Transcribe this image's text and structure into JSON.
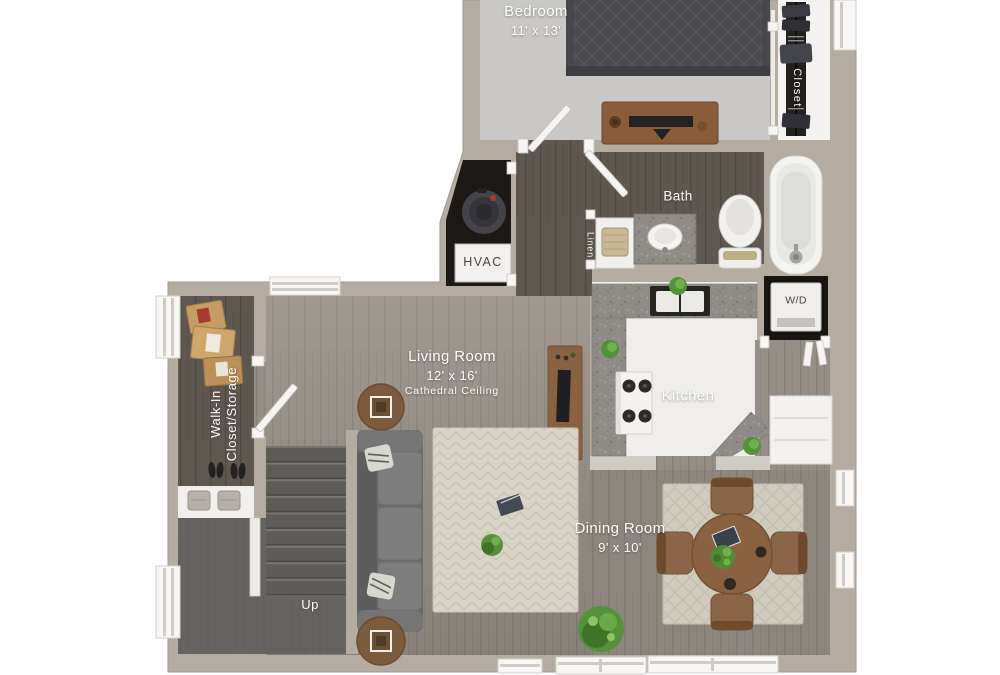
{
  "rooms": {
    "bedroom": {
      "label": "Bedroom",
      "dims": "11' x 13'"
    },
    "bedroom_closet": {
      "label": "Closet"
    },
    "bath": {
      "label": "Bath"
    },
    "linen": {
      "label": "Linen"
    },
    "hvac": {
      "label": "HVAC"
    },
    "kitchen": {
      "label": "Kitchen"
    },
    "laundry": {
      "label": "W/D"
    },
    "living": {
      "label": "Living Room",
      "dims": "12' x 16'",
      "note": "Cathedral Ceiling"
    },
    "dining": {
      "label": "Dining Room",
      "dims": "9' x 10'"
    },
    "walk_in": {
      "label_line1": "Walk-In",
      "label_line2": "Closet/Storage"
    },
    "stairs": {
      "label": "Up"
    }
  },
  "colors": {
    "background": "#ffffff",
    "wall": "#b5aca1",
    "wall_edge": "#a29a8e",
    "wood_dark": "#5f5850",
    "wood_mid": "#958e86",
    "carpet_bedroom": "#c9c8c6",
    "carpet_stairs": "#5e5c5a",
    "tile_kitchen": "#efeeec",
    "granite": "#8f8c87",
    "rug_living": "#dad5c8",
    "rug_dining": "#cfcbbd",
    "sofa": "#6a6a6a",
    "wood_furniture": "#8a6242",
    "plant": "#55913a",
    "closet_interior": "#1b1815",
    "fixture_white": "#f3f3f1",
    "label_text": "#ffffff"
  }
}
